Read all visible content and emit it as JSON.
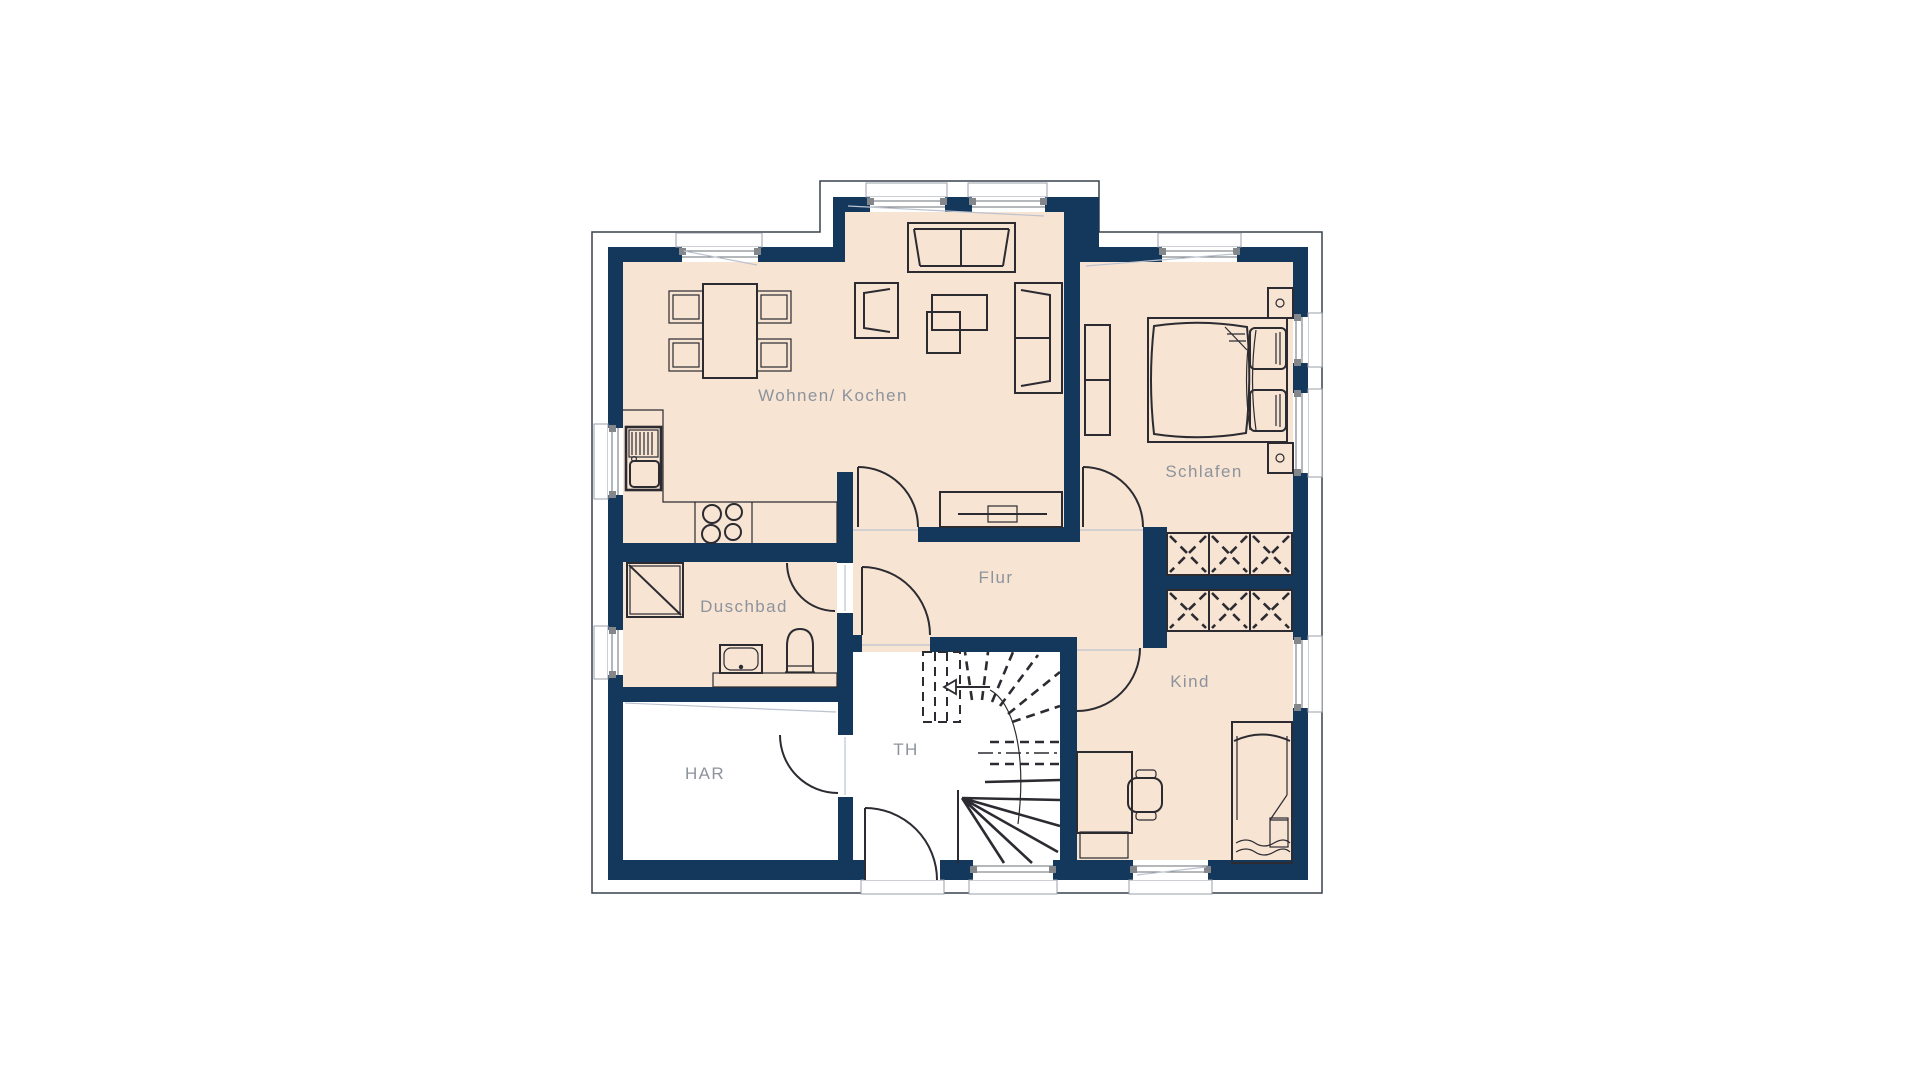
{
  "plan": {
    "kind": "architectural-floor-plan",
    "storey": "upper floor apartment with winder staircase"
  },
  "colors": {
    "wall": "#14375c",
    "floor": "#f7e4d3",
    "utility_floor": "#ffffff",
    "line": "#2b2b31",
    "label": "#8d939d",
    "faint": "#bcc3cf",
    "cap": "#83878c",
    "sillline": "#9aa0a8",
    "outline": "#39404a",
    "glassline": "#6a7077",
    "background": "#ffffff"
  },
  "rooms": [
    {
      "id": "wohnen-kochen",
      "label": "Wohnen/ Kochen",
      "cx": 833,
      "cy": 396
    },
    {
      "id": "schlafen",
      "label": "Schlafen",
      "cx": 1204,
      "cy": 472
    },
    {
      "id": "flur",
      "label": "Flur",
      "cx": 996,
      "cy": 578
    },
    {
      "id": "duschbad",
      "label": "Duschbad",
      "cx": 744,
      "cy": 607
    },
    {
      "id": "kind",
      "label": "Kind",
      "cx": 1190,
      "cy": 682
    },
    {
      "id": "har",
      "label": "HAR",
      "cx": 705,
      "cy": 774
    },
    {
      "id": "th",
      "label": "TH",
      "cx": 906,
      "cy": 750
    }
  ],
  "furniture_icons": [
    "dining-table-icon",
    "dining-chair-icon",
    "sofa-icon",
    "armchair-icon",
    "coffee-table-icon",
    "tv-sideboard-icon",
    "kitchen-counter-icon",
    "kitchen-sink-icon",
    "cooktop-icon",
    "shower-icon",
    "washbasin-icon",
    "toilet-icon",
    "double-bed-icon",
    "nightstand-icon",
    "dresser-icon",
    "wardrobe-x-icon",
    "single-bed-icon",
    "desk-icon",
    "desk-chair-icon",
    "winder-staircase-icon",
    "stair-direction-arrow-icon"
  ],
  "openings": {
    "windows": 11,
    "interior_doors": 6,
    "entrance_doors": 1
  }
}
